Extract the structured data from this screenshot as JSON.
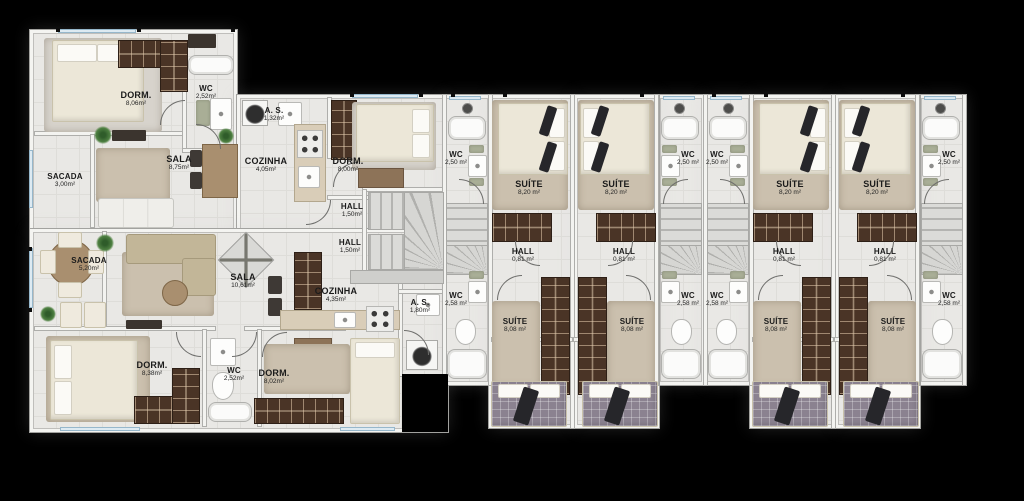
{
  "plan": {
    "type": "architectural-floor-plan",
    "background_color": "#000000",
    "palette": {
      "floor": "#e9e8e5",
      "wall": "#f4f4f1",
      "wood_dark": "#4a3426",
      "rug_tan": "#cbc0ae",
      "bed_cream": "#ece7d8",
      "bed_plaid": "#8b8290",
      "label_text": "#1b1b1b",
      "window_glass": "#ddeaf2"
    },
    "left_building": {
      "upper_unit": {
        "rooms": [
          {
            "name": "DORM.",
            "area": "8,06m²"
          },
          {
            "name": "WC",
            "area": "2,52m²"
          },
          {
            "name": "A. S.",
            "area": "1,32m²"
          },
          {
            "name": "SALA",
            "area": "8,75m²"
          },
          {
            "name": "COZINHA",
            "area": "4,05m²"
          },
          {
            "name": "DORM.",
            "area": "8,00m²"
          },
          {
            "name": "HALL",
            "area": "1,50m²"
          },
          {
            "name": "SACADA",
            "area": "3,00m²"
          }
        ]
      },
      "lower_unit": {
        "rooms": [
          {
            "name": "SACADA",
            "area": "5,20m²"
          },
          {
            "name": "SALA",
            "area": "10,61m²"
          },
          {
            "name": "HALL",
            "area": "1,50m²"
          },
          {
            "name": "COZINHA",
            "area": "4,35m²"
          },
          {
            "name": "DORM.",
            "area": "8,38m²"
          },
          {
            "name": "WC",
            "area": "2,52m²"
          },
          {
            "name": "DORM.",
            "area": "8,02m²"
          },
          {
            "name": "A. S.",
            "area": "1,80m²"
          }
        ]
      }
    },
    "right_building": {
      "units": [
        {
          "wc_upper": {
            "name": "WC",
            "area": "2,50 m²"
          },
          "suite_upper": {
            "name": "SUÍTE",
            "area": "8,20 m²"
          },
          "hall": {
            "name": "HALL",
            "area": "0,81 m²"
          },
          "wc_lower": {
            "name": "WC",
            "area": "2,58 m²"
          },
          "suite_lower": {
            "name": "SUÍTE",
            "area": "8,08 m²"
          }
        },
        {
          "wc_upper": {
            "name": "WC",
            "area": "2,50 m²"
          },
          "suite_upper": {
            "name": "SUÍTE",
            "area": "8,20 m²"
          },
          "hall": {
            "name": "HALL",
            "area": "0,81 m²"
          },
          "wc_lower": {
            "name": "WC",
            "area": "2,58 m²"
          },
          "suite_lower": {
            "name": "SUÍTE",
            "area": "8,08 m²"
          }
        },
        {
          "wc_upper": {
            "name": "WC",
            "area": "2,50 m²"
          },
          "suite_upper": {
            "name": "SUÍTE",
            "area": "8,20 m²"
          },
          "hall": {
            "name": "HALL",
            "area": "0,81 m²"
          },
          "wc_lower": {
            "name": "WC",
            "area": "2,58 m²"
          },
          "suite_lower": {
            "name": "SUÍTE",
            "area": "8,08 m²"
          }
        },
        {
          "wc_upper": {
            "name": "WC",
            "area": "2,50 m²"
          },
          "suite_upper": {
            "name": "SUÍTE",
            "area": "8,20 m²"
          },
          "hall": {
            "name": "HALL",
            "area": "0,81 m²"
          },
          "wc_lower": {
            "name": "WC",
            "area": "2,58 m²"
          },
          "suite_lower": {
            "name": "SUÍTE",
            "area": "8,08 m²"
          }
        }
      ]
    }
  }
}
